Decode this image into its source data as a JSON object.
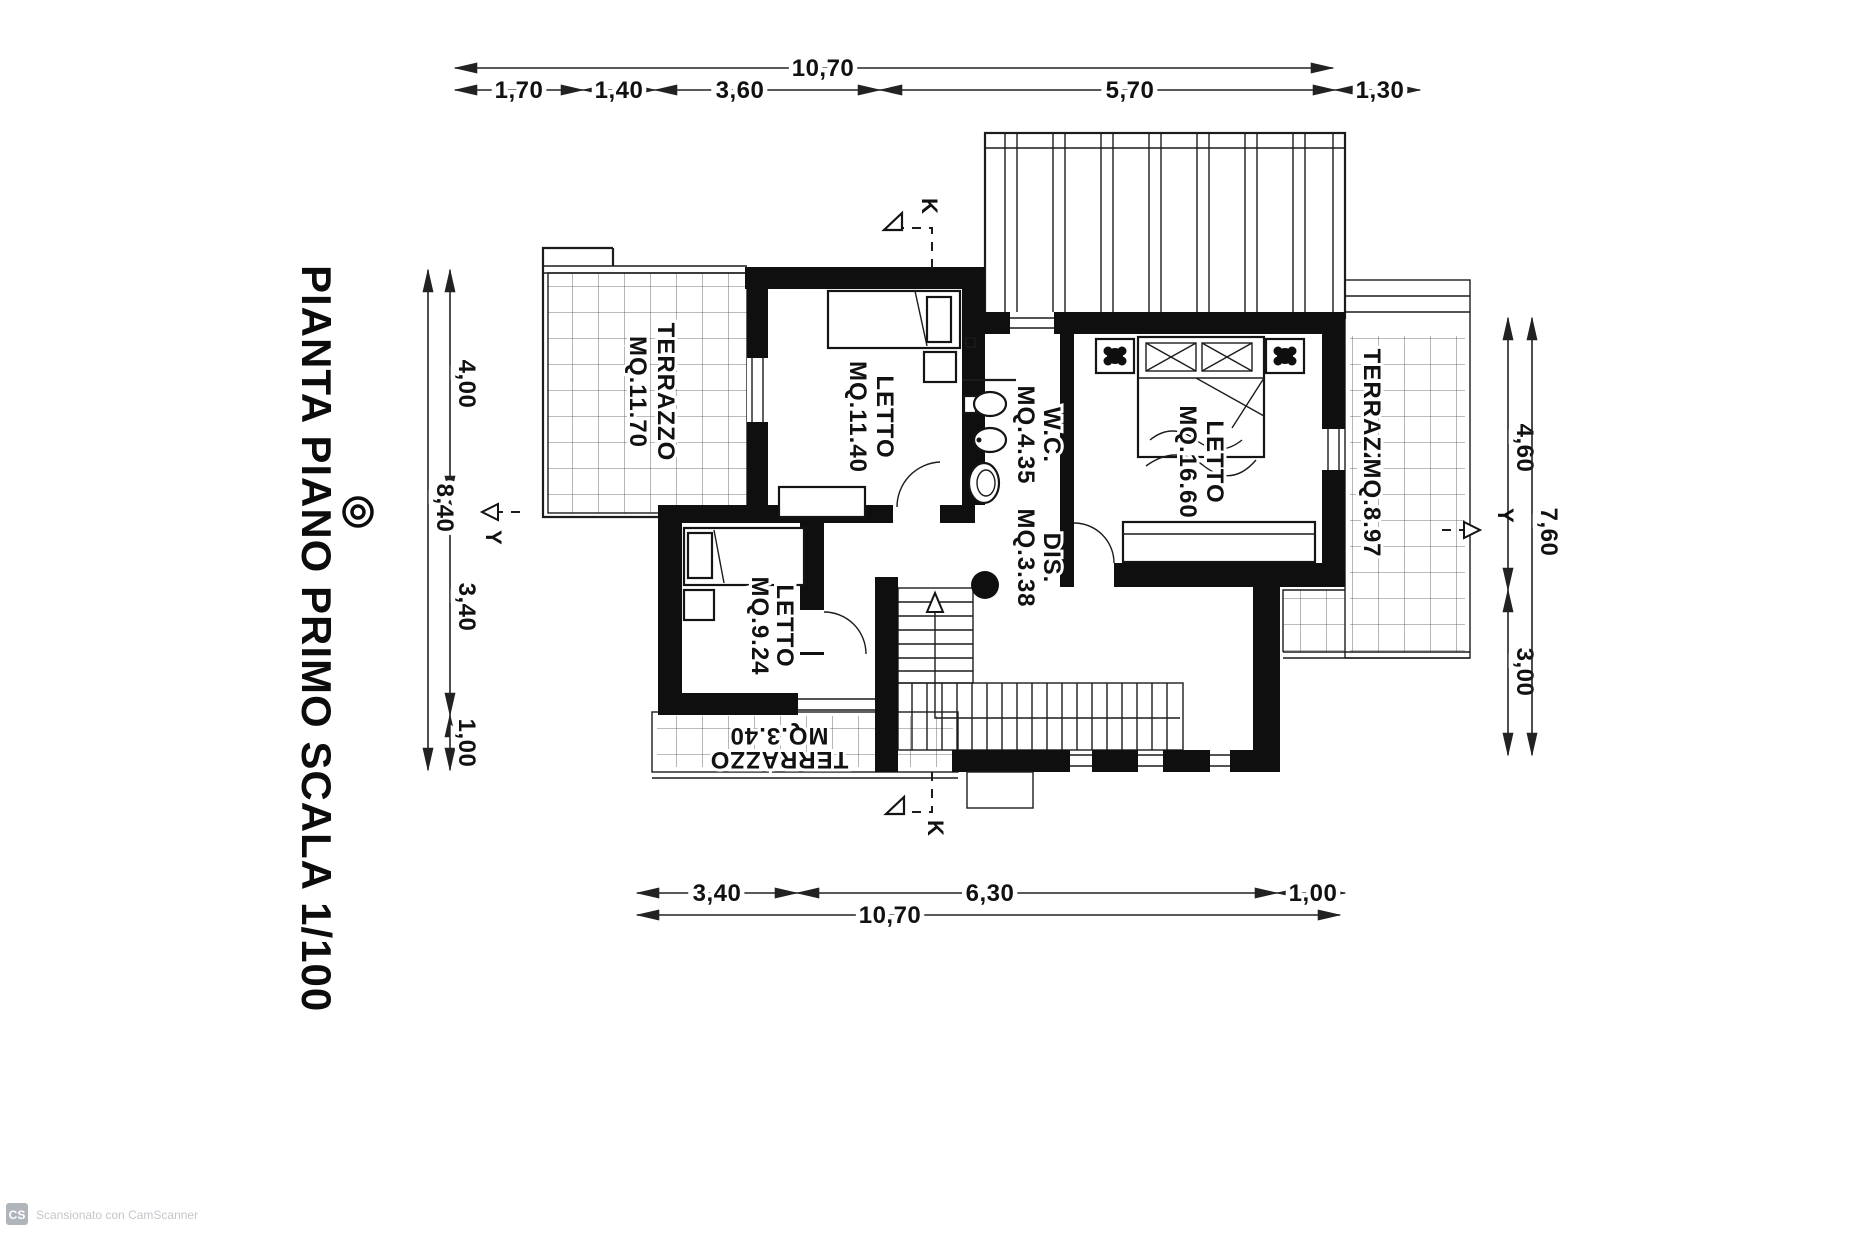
{
  "plan": {
    "title": "PIANTA PIANO PRIMO  SCALA 1/100",
    "rooms": {
      "terrazzo_nw": {
        "name": "TERRAZZO",
        "area": "MQ.11.70"
      },
      "letto_nw": {
        "name": "LETTO",
        "area": "MQ.11.40"
      },
      "wc": {
        "name": "W.C.",
        "area": "MQ.4.35"
      },
      "dis": {
        "name": "DIS.",
        "area": "MQ.3.38"
      },
      "letto_e": {
        "name": "LETTO",
        "area": "MQ.16.60"
      },
      "terrazzo_e": {
        "name": "TERRAZZO",
        "area": "MQ.8.97"
      },
      "letto_sw": {
        "name": "LETTO",
        "area": "MQ.9.24"
      },
      "terrazzo_s": {
        "name": "TERRAZZO",
        "area": "MQ.3.40"
      }
    },
    "dimensions": {
      "top_total": "10,70",
      "top": [
        "1,70",
        "1,40",
        "3,60",
        "5,70",
        "1,30"
      ],
      "left": [
        "4,00",
        "3,40",
        "1,00"
      ],
      "left_total": "8,40",
      "right": [
        "4,60",
        "3,00"
      ],
      "right_total": "7,60",
      "bottom": [
        "3,40",
        "6,30",
        "1,00"
      ],
      "bottom_total": "10,70"
    },
    "section_markers": {
      "top": "K",
      "bottom": "K",
      "left": "Y",
      "right": "Y"
    }
  },
  "watermark": {
    "badge": "CS",
    "text": "Scansionato con CamScanner"
  }
}
